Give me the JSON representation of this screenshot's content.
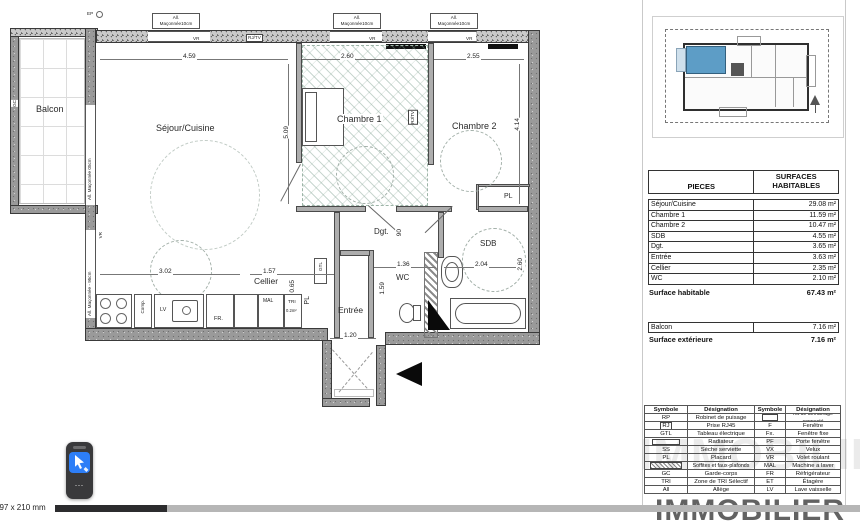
{
  "viewer": {
    "page_size_label": "297 x 210 mm"
  },
  "watermark_text": "IMMOBILIER",
  "floating_widget": {
    "more_glyph": "⋯"
  },
  "plan": {
    "room_labels": {
      "balcon": "Balcon",
      "sejour_cuisine": "Séjour/Cuisine",
      "chambre1": "Chambre 1",
      "chambre2": "Chambre 2",
      "dgt": "Dgt.",
      "sdb": "SDB",
      "wc": "WC",
      "entree": "Entrée",
      "cellier": "Cellier",
      "pl_closet": "PL",
      "pl_cellier": "PL"
    },
    "dimensions": {
      "sejour_width": "4.59",
      "chambre1_width": "2.60",
      "chambre2_width": "2.55",
      "chambre1_height": "5.09",
      "chambre2_height": "4.14",
      "kitchen_width": "3.02",
      "cellier_width": "1.57",
      "cellier_height": "0.65",
      "wc_width": "1.36",
      "sdb_width": "2.04",
      "sdb_height": "2.60",
      "wc_height": "1.59",
      "entree_width": "1.20",
      "dgt_width": "90"
    },
    "wall_labels": {
      "top_window_line1": "All.",
      "top_window_line2": "Maçonnée10cm",
      "balcony_window": "All. Maçonnée 05cm",
      "left_window": "All. Maçonnée - 95cm"
    },
    "small_labels": {
      "ep": "EP",
      "vr": "VR",
      "fixe": "Fixe",
      "rj_tv": "RJ/TV",
      "gc": "GC",
      "comp": "Comp.",
      "lv": "LV",
      "fr": "FR.",
      "mal": "MAL",
      "tri": "TRI",
      "tri_area": "0.2m²",
      "gtl": "GTL"
    }
  },
  "surface_table": {
    "header": {
      "pieces": "PIECES",
      "surfaces_line1": "SURFACES",
      "surfaces_line2": "HABITABLES"
    },
    "rows": [
      {
        "name": "Séjour/Cuisine",
        "value": "29.08 m²"
      },
      {
        "name": "Chambre 1",
        "value": "11.59 m²"
      },
      {
        "name": "Chambre 2",
        "value": "10.47 m²"
      },
      {
        "name": "SDB",
        "value": "4.55 m²"
      },
      {
        "name": "Dgt.",
        "value": "3.65 m²"
      },
      {
        "name": "Entrée",
        "value": "3.63 m²"
      },
      {
        "name": "Cellier",
        "value": "2.35 m²"
      },
      {
        "name": "WC",
        "value": "2.10 m²"
      }
    ],
    "total": {
      "label": "Surface habitable",
      "value": "67.43 m²"
    },
    "exterior_row": {
      "name": "Balcon",
      "value": "7.16 m²"
    },
    "exterior_total": {
      "label": "Surface extérieure",
      "value": "7.16 m²"
    }
  },
  "legend": {
    "header": {
      "symbole1": "Symbole",
      "designation1": "Désignation",
      "symbole2": "Symbole",
      "designation2": "Désignation"
    },
    "rows": [
      {
        "s1": "RP",
        "d1": "Robinet de puisage",
        "s2": "",
        "d2": "Kit de démarrage connecté"
      },
      {
        "s1": "RJ",
        "d1": "Prise RJ45",
        "s2": "F",
        "d2": "Fenêtre"
      },
      {
        "s1": "GTL",
        "d1": "Tableau électrique",
        "s2": "Fx.",
        "d2": "Fenêtre fixe"
      },
      {
        "s1": "",
        "d1": "Radiateur",
        "s2": "PF",
        "d2": "Porte fenêtre"
      },
      {
        "s1": "SS",
        "d1": "Sèche serviette",
        "s2": "VX",
        "d2": "Velux"
      },
      {
        "s1": "PL",
        "d1": "Placard",
        "s2": "VR",
        "d2": "Volet roulant"
      },
      {
        "s1": "",
        "d1": "Soffites et faux-plafonds",
        "s2": "MAL",
        "d2": "Machine a laver"
      },
      {
        "s1": "GC",
        "d1": "Garde-corps",
        "s2": "FR",
        "d2": "Réfrigérateur"
      },
      {
        "s1": "TRI",
        "d1": "Zone de TRI Sélectif",
        "s2": "ET",
        "d2": "Étagère"
      },
      {
        "s1": "All",
        "d1": "Allège",
        "s2": "LV",
        "d2": "Lave vaisselle"
      }
    ]
  },
  "colors": {
    "unit_highlight": "#5d9dc6",
    "widget_accent": "#2d7ef7"
  }
}
